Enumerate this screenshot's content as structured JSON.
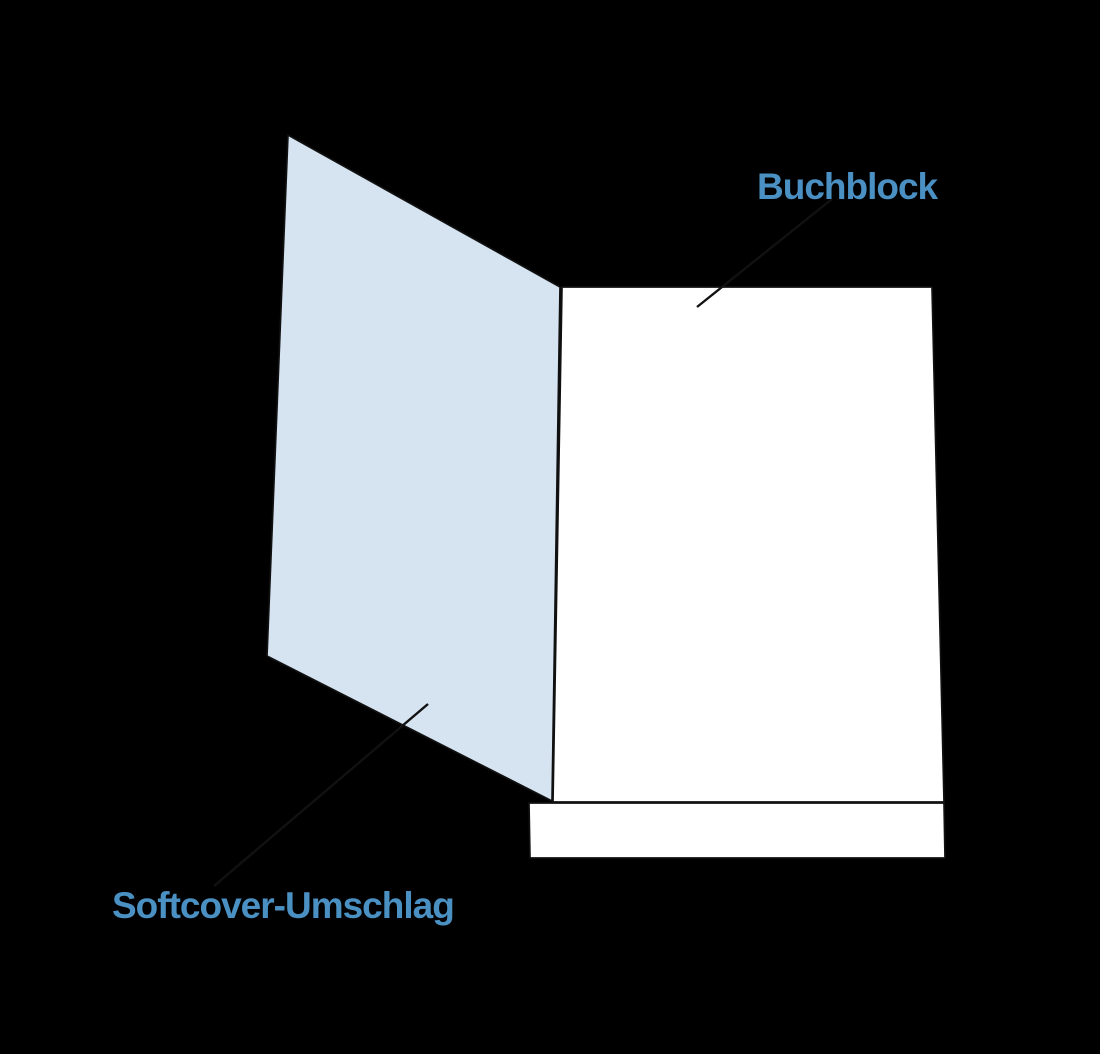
{
  "canvas": {
    "width": 1100,
    "height": 1054,
    "background": "#000000"
  },
  "palette": {
    "label_blue": "#4a90c3",
    "cover_fill": "#d6e4f2",
    "page_fill": "#ffffff",
    "outline": "#111111"
  },
  "labels": {
    "buchblock": {
      "text": "Buchblock",
      "x": 757,
      "y": 199,
      "color": "#4a90c3"
    },
    "softcover": {
      "text": "Softcover-Umschlag",
      "x": 112,
      "y": 918,
      "color": "#4a90c3"
    }
  },
  "shapes": {
    "cover": {
      "points": "288,135 560,287 552,801 267,656",
      "fill": "#d6e4f2",
      "stroke": "#111111"
    },
    "book_block_front": {
      "points": "562,287 932,287 944,802 553,802",
      "fill": "#ffffff",
      "stroke": "#111111"
    },
    "book_block_pages_edge": {
      "points": "529,803 944,803 945,858 530,858",
      "fill": "#ffffff",
      "stroke": "#111111"
    },
    "leader_buchblock": {
      "x1": 832,
      "y1": 199,
      "x2": 697,
      "y2": 307,
      "stroke": "#111111"
    },
    "leader_softcover": {
      "x1": 214,
      "y1": 886,
      "x2": 428,
      "y2": 704,
      "stroke": "#111111"
    }
  }
}
